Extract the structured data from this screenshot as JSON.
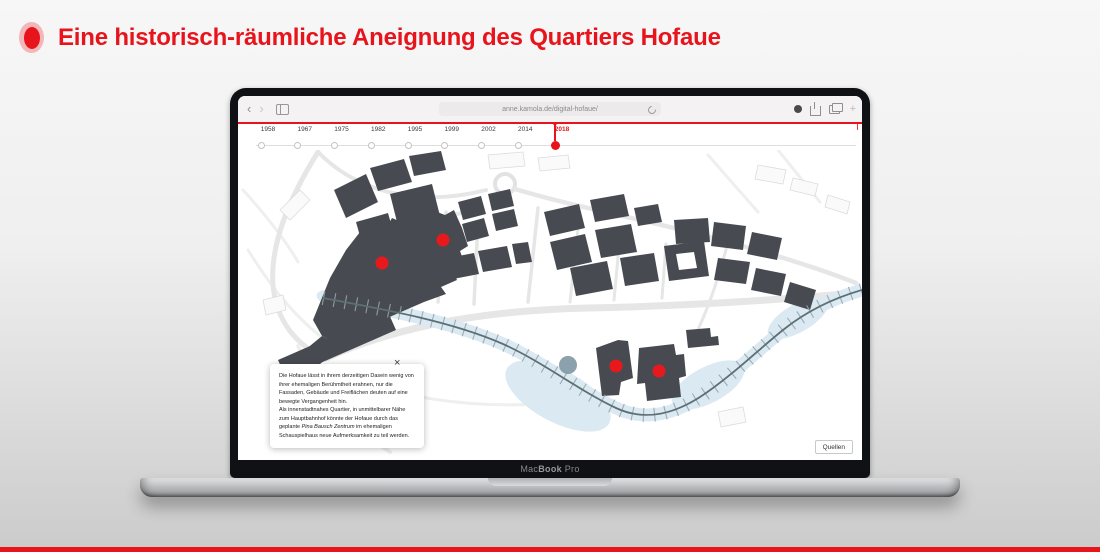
{
  "header": {
    "title": "Eine historisch-räumliche Aneignung des Quartiers Hofaue"
  },
  "colors": {
    "accent": "#e8141c",
    "building": "#474b51",
    "river": "#dbe9f2",
    "rail": "#5e6f73",
    "station": "#7f97a2",
    "marker": "#e8191c"
  },
  "laptop": {
    "brand_prefix": "Mac",
    "brand_bold": "Book",
    "brand_suffix": " Pro"
  },
  "browser": {
    "back_icon": "‹",
    "forward_icon": "›",
    "new_tab_icon": "+",
    "url": "anne.kamola.de/digital-hofaue/"
  },
  "timeline": {
    "years": [
      "1958",
      "1967",
      "1975",
      "1982",
      "1995",
      "1999",
      "2002",
      "2014",
      "2018"
    ],
    "active_year": "2018",
    "start_x": 23,
    "spacing": 36.75
  },
  "map": {
    "red_markers": [
      {
        "x": 144,
        "y": 113
      },
      {
        "x": 205,
        "y": 90
      },
      {
        "x": 378,
        "y": 216
      },
      {
        "x": 421,
        "y": 221
      }
    ],
    "marker_radius": 6.5,
    "station_marker": {
      "x": 330,
      "y": 215,
      "r": 9
    }
  },
  "popup": {
    "paragraph1": "Die Hofaue lässt in ihrem derzeitigen Dasein wenig von ihrer ehemaligen Berühmtheit erahnen, nur die Fassaden, Gebäude und Freiflächen deuten auf eine bewegte Vergangenheit hin.",
    "paragraph2_pre": "Als innenstadtnahes Quartier, in unmittelbarer Nähe zum Hauptbahnhof könnte der Hofaue durch das geplante ",
    "paragraph2_italic": "Pina Bausch Zentrum",
    "paragraph2_post": " im ehemaligen Schauspielhaus neue Aufmerksamkeit zu teil werden.",
    "close_icon": "×"
  },
  "sources_button": {
    "label": "Quellen"
  }
}
